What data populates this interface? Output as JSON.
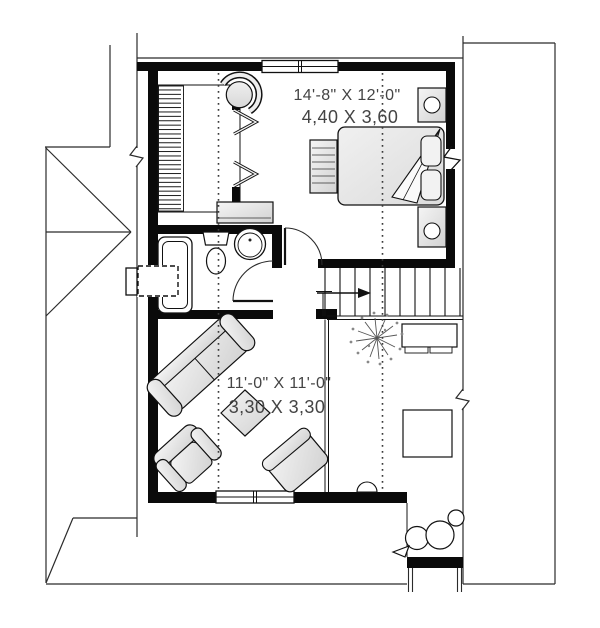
{
  "plan": {
    "bedroom": {
      "imperial_dims": "14'-8\" X 12'-0\"",
      "metric_dims": "4,40 X 3,60"
    },
    "living_room": {
      "imperial_dims": "11'-0\" X 11'-0\"",
      "metric_dims": "3,30 X 3,30"
    }
  },
  "colors": {
    "background": "#ffffff",
    "wall": "#0a0a0a",
    "line": "#2b2b2b",
    "furniture_light": "#f3f3f3",
    "furniture_dark": "#d2d2d2",
    "text": "#444444"
  }
}
